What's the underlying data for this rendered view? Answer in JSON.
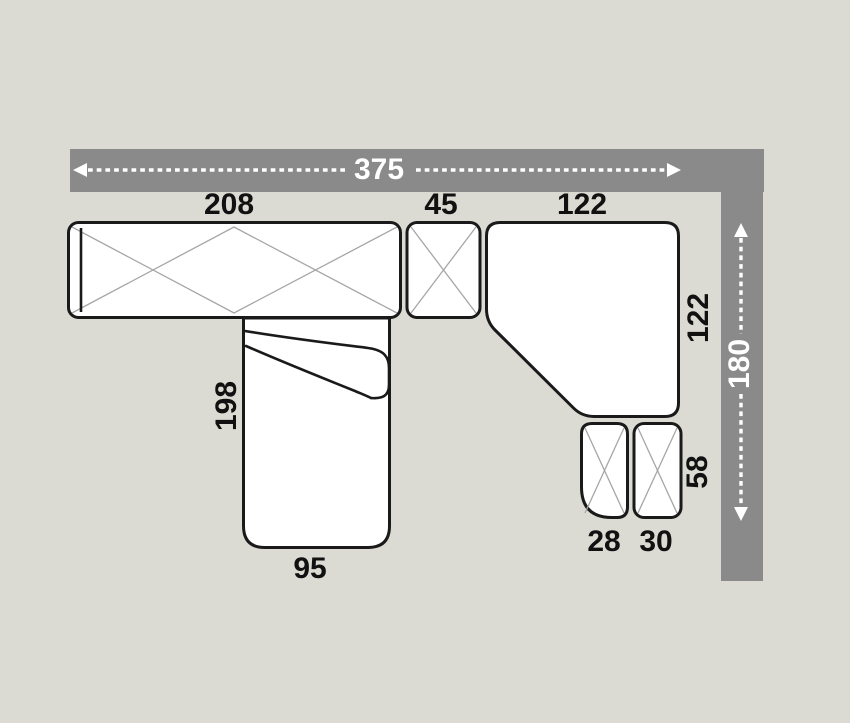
{
  "diagram": {
    "kind": "sectional-sofa-floorplan",
    "overall": {
      "width": "375",
      "depth": "180"
    },
    "pieces": {
      "sofa": {
        "width": "208"
      },
      "connector": {
        "width": "45"
      },
      "corner": {
        "width": "122",
        "depth": "122"
      },
      "chaise": {
        "length": "198",
        "width": "95"
      },
      "pouf_small": {
        "width": "28"
      },
      "pouf_large": {
        "width": "30"
      },
      "pouf_depth": "58"
    }
  },
  "colors": {
    "background": "#dbdbd3",
    "dimension_bar": "#8a8a8a",
    "piece_fill": "#ffffff",
    "piece_outline": "#1a1a1a",
    "cross_lines": "#a6a6a6",
    "label_dark": "#111111",
    "label_light": "#ffffff"
  }
}
